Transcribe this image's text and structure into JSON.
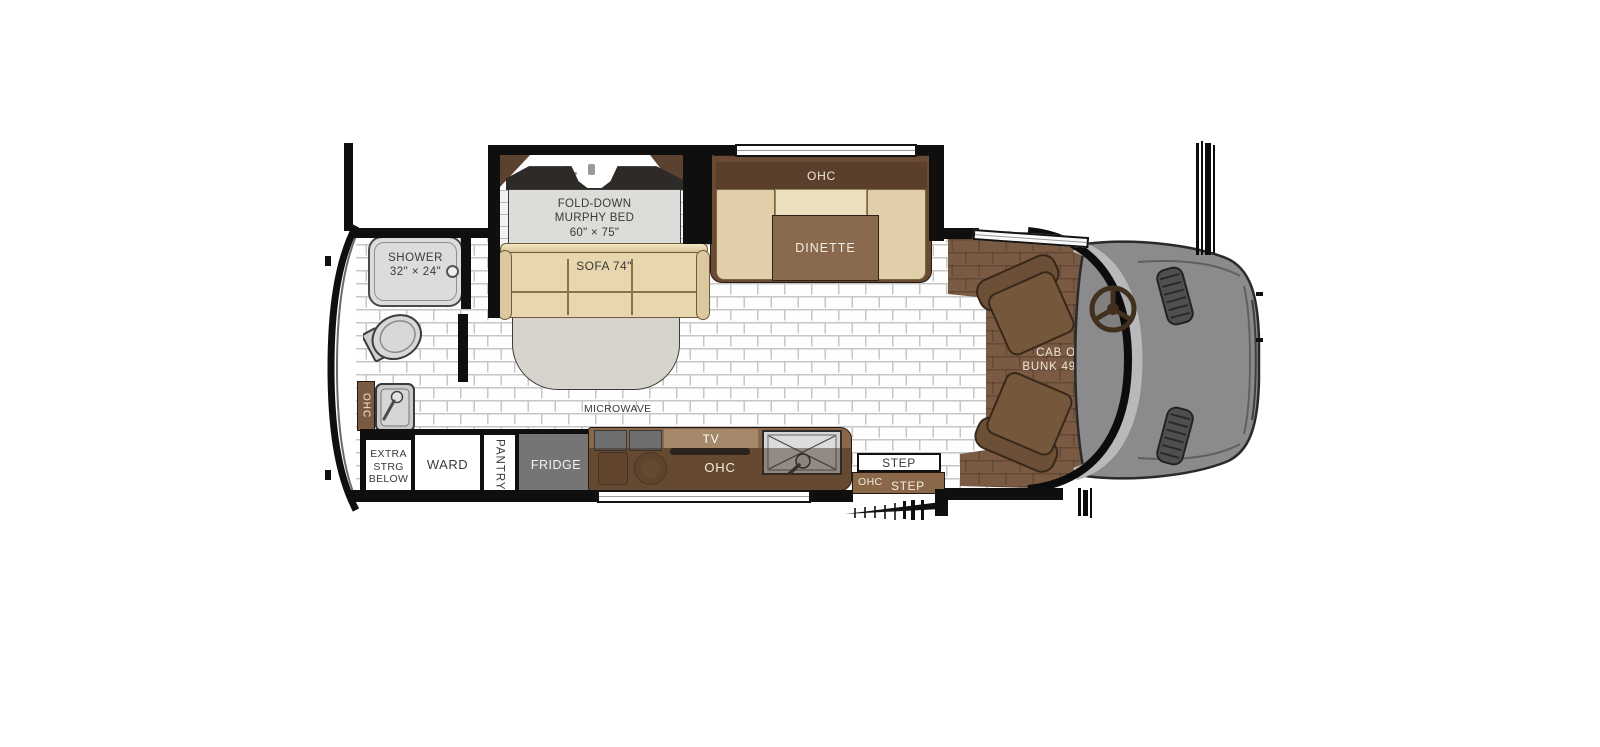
{
  "colors": {
    "wall": "#0f0f0f",
    "floor_tile": "#ffffff",
    "floor_grout": "#c6c6c6",
    "cab_floor_brown": "#7a5a42",
    "furniture_tan": "#e8d6ae",
    "cabinet_dark_brown": "#5a3f2d",
    "counter_brown": "#8a6748",
    "table_brown": "#8a6a4f",
    "fridge_gray": "#757575",
    "hood_gray": "#8b8b8d",
    "windshield_gray": "#b9b9bb",
    "bed_gray": "#dddcd8",
    "shower_gray": "#dcdcdc",
    "text_dark": "#3a3a3a",
    "text_light": "#f3ece2"
  },
  "labels": {
    "murphy": {
      "line1": "FOLD-DOWN",
      "line2": "MURPHY BED",
      "line3": "60\" × 75\""
    },
    "sofa": "SOFA 74\"",
    "dinette_ohc": "OHC",
    "dinette": "DINETTE",
    "shower": {
      "line1": "SHOWER",
      "line2": "32\" × 24\""
    },
    "rear_ohc": "OHC",
    "extra_storage": {
      "line1": "EXTRA",
      "line2": "STRG",
      "line3": "BELOW"
    },
    "wardrobe": "WARD",
    "pantry": "PANTRY",
    "fridge": "FRIDGE",
    "microwave": "MICROWAVE",
    "tv": "TV",
    "kitchen_ohc": "OHC",
    "step": "STEP",
    "entry": {
      "ohc": "OHC",
      "step": "STEP"
    },
    "cab": {
      "line1": "CAB OVER",
      "line2": "BUNK 49\" × 78\""
    }
  }
}
